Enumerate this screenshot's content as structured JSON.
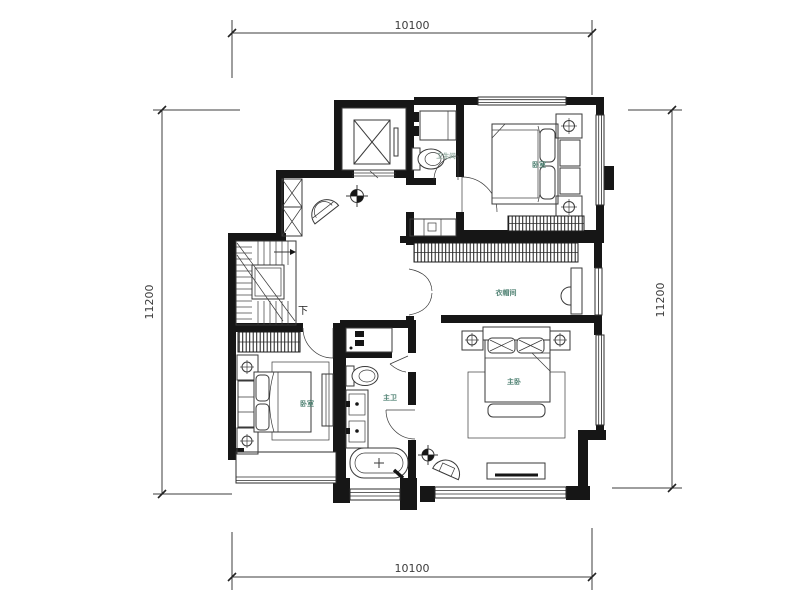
{
  "page": {
    "background": "#ffffff",
    "type": "apartment-floor-plan"
  },
  "colors": {
    "wall": "#161616",
    "line": "#3a3a3a",
    "room_label": "#4e8172",
    "room_label_light": "#93aca1",
    "dimension_text": "#3c3c3c"
  },
  "dimensions": {
    "top": "10100",
    "bottom": "10100",
    "left": "11200",
    "right": "11200"
  },
  "rooms": {
    "bathroom": "卫生间",
    "bedroom_top_right": "卧室",
    "cloakroom": "衣帽间",
    "master_bedroom": "主卧",
    "master_bathroom": "主卫",
    "bedroom_bottom_left": "卧室"
  },
  "stairs": {
    "direction_label": "下"
  }
}
